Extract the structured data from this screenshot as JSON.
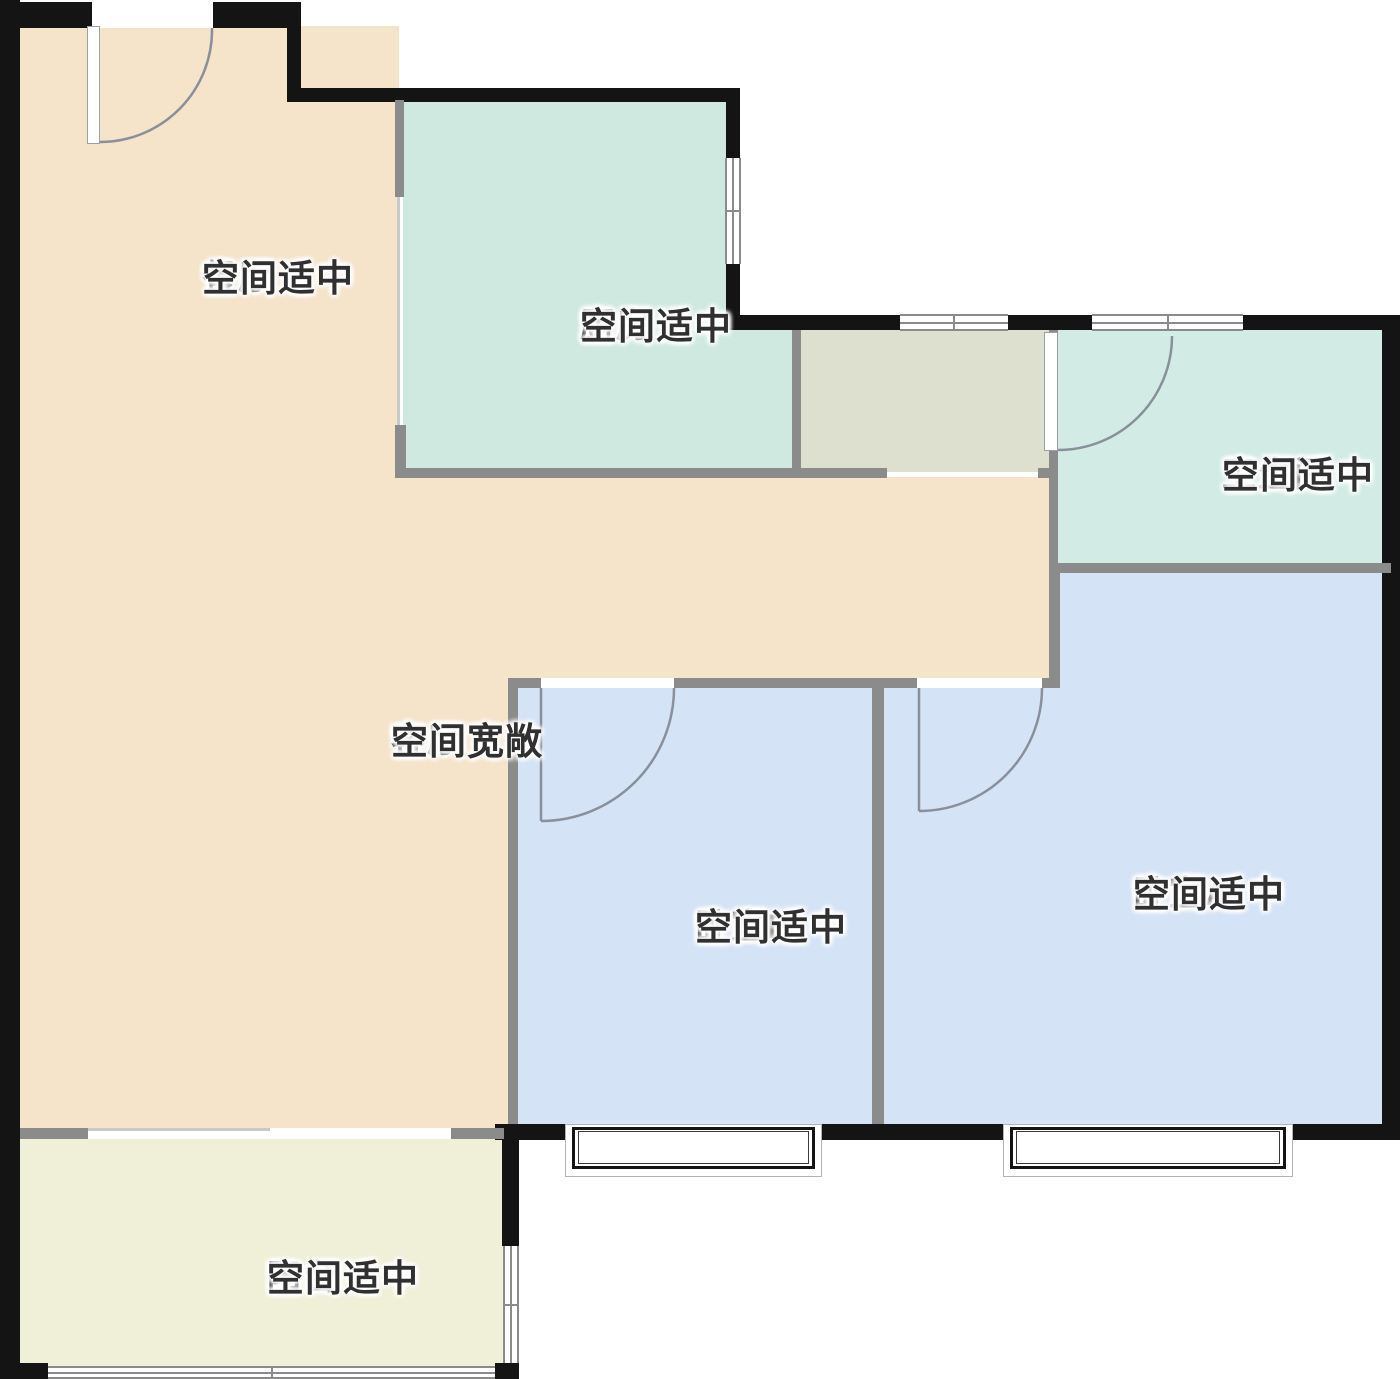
{
  "rooms": {
    "dining": {
      "name": "餐厅",
      "desc": "空间适中"
    },
    "kitchen": {
      "name": "厨房",
      "desc": "空间适中"
    },
    "bathroom": {
      "name": "卫生间",
      "desc": "空间适中"
    },
    "living": {
      "name": "客厅",
      "desc": "空间宽敞"
    },
    "bedroomB": {
      "name": "卧室B",
      "desc": "空间适中"
    },
    "bedroomA": {
      "name": "卧室A",
      "desc": "空间适中"
    },
    "balcony": {
      "name": "阳台",
      "desc": "空间适中"
    }
  },
  "colors": {
    "peach": "#f5e3ca",
    "teal": "#cfe9e1",
    "bathteal": "#d2ece5",
    "olive": "#dde0ce",
    "blue": "#d5e3f7",
    "cream": "#f0efd7",
    "wallblack": "#141414",
    "wallgray": "#8b8b8b",
    "linelight": "#c9c9c9",
    "arc": "#8a9099",
    "text": "#303030"
  }
}
